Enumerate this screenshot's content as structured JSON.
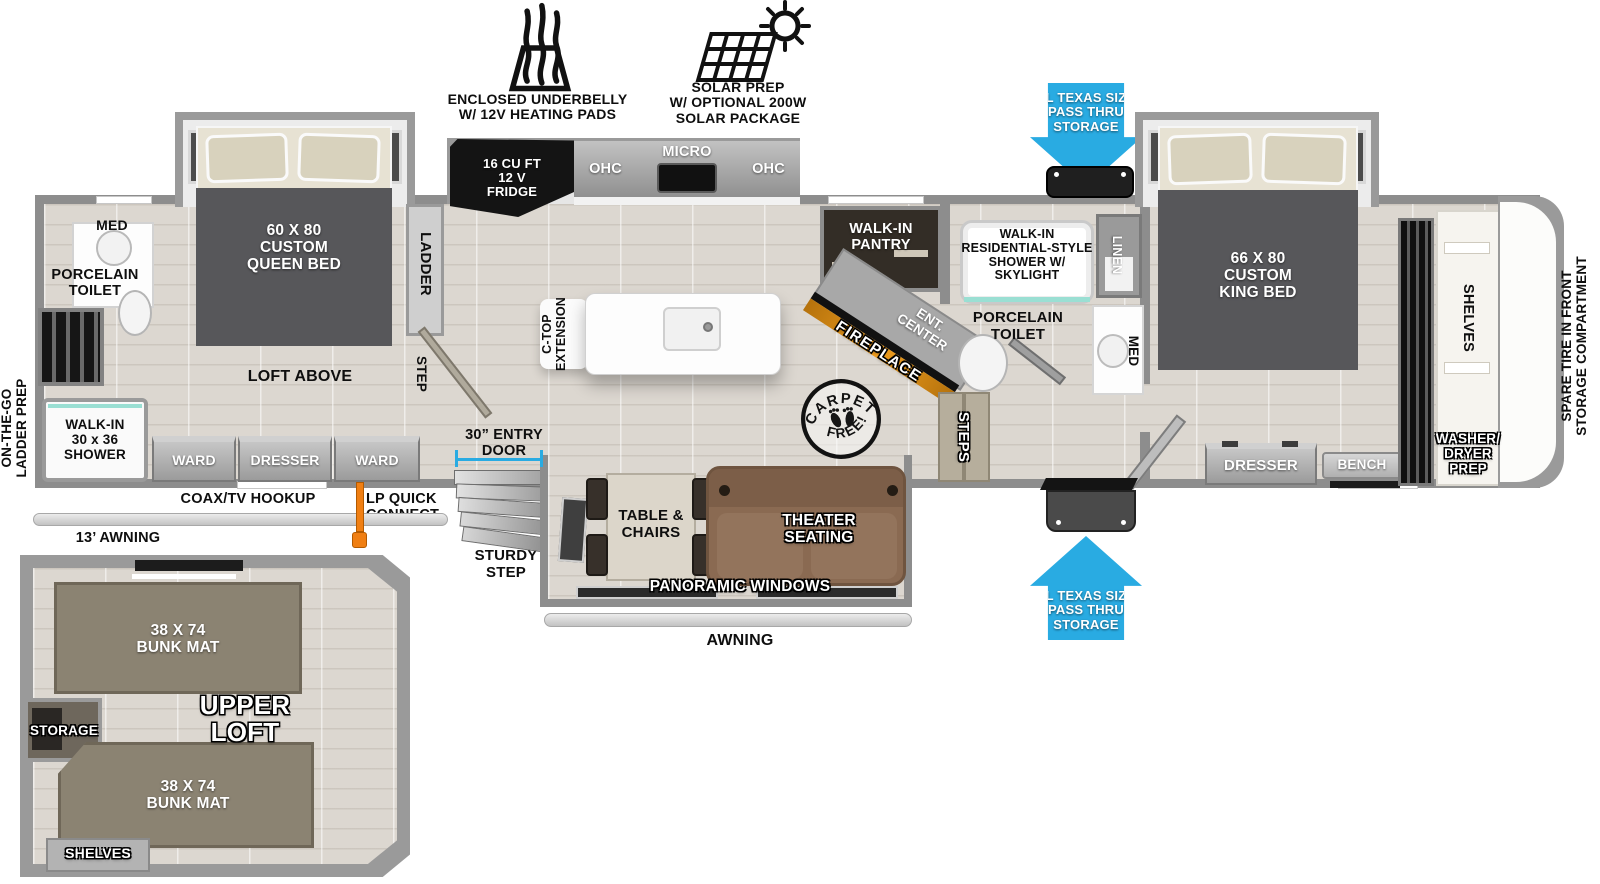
{
  "colors": {
    "arrow_blue": "#29abe2",
    "wall": "#8d8d8d",
    "bed": "#57575a",
    "sofa": "#8a6a52",
    "bunk": "#8b8372",
    "fireplace": "#ef9d1f",
    "lp_orange": "#f07f13",
    "shower_teal": "#9adfd3"
  },
  "header": {
    "underbelly": "ENCLOSED UNDERBELLY\nW/ 12V HEATING PADS",
    "solar": "SOLAR PREP\nW/ OPTIONAL 200W\nSOLAR PACKAGE"
  },
  "storage": {
    "top_arrow": "XL TEXAS SIZE\nPASS THRU\nSTORAGE",
    "bottom_arrow": "XL TEXAS SIZE\nPASS THRU\nSTORAGE"
  },
  "rear": {
    "med": "MED",
    "porcelain_toilet": "PORCELAIN\nTOILET",
    "ladder_prep": "ON-THE-GO\nLADDER PREP",
    "walk_in_shower": "WALK-IN\n30 x 36\nSHOWER",
    "queen_bed": "60 X  80\nCUSTOM\nQUEEN BED",
    "ladder": "LADDER",
    "loft_above": "LOFT ABOVE",
    "step": "STEP",
    "ward_left": "WARD",
    "dresser": "DRESSER",
    "ward_right": "WARD",
    "coax": "COAX/TV HOOKUP",
    "lp_quick_connect": "LP QUICK\nCONNECT",
    "awning_13": "13’ AWNING"
  },
  "kitchen": {
    "fridge": "16 CU FT\n12 V\nFRIDGE",
    "ohc_left": "OHC",
    "micro": "MICRO",
    "ohc_right": "OHC",
    "ctop_extension": "C-TOP\nEXTENSION",
    "entry_door": "30” ENTRY\nDOOR",
    "sturdy_step": "STURDY\nSTEP"
  },
  "badges": {
    "carpet_top": "CARPET",
    "carpet_bottom": "FREE!"
  },
  "mid": {
    "pantry": "WALK-IN\nPANTRY",
    "ent_center": "ENT.\nCENTER",
    "fireplace": "FIREPLACE",
    "shower": "WALK-IN\nRESIDENTIAL-STYLE\nSHOWER W/\nSKYLIGHT",
    "linen": "LINEN",
    "porcelain_toilet": "PORCELAIN\nTOILET",
    "med": "MED",
    "steps": "STEPS"
  },
  "living": {
    "table_chairs": "TABLE &\nCHAIRS",
    "theater_seating": "THEATER\nSEATING",
    "panoramic_windows": "PANORAMIC WINDOWS",
    "awning": "AWNING"
  },
  "front": {
    "king_bed": "66 X  80\nCUSTOM\nKING BED",
    "dresser": "DRESSER",
    "bench": "BENCH",
    "shelves": "SHELVES",
    "washer_dryer": "WASHER/\nDRYER\nPREP",
    "spare_tire": "SPARE TIRE IN FRONT\nSTORAGE COMPARTMENT"
  },
  "loft": {
    "bunk_top": "38 X 74\nBUNK MAT",
    "bunk_bottom": "38 X 74\nBUNK MAT",
    "upper_loft": "UPPER\nLOFT",
    "storage": "STORAGE",
    "shelves": "SHELVES"
  }
}
